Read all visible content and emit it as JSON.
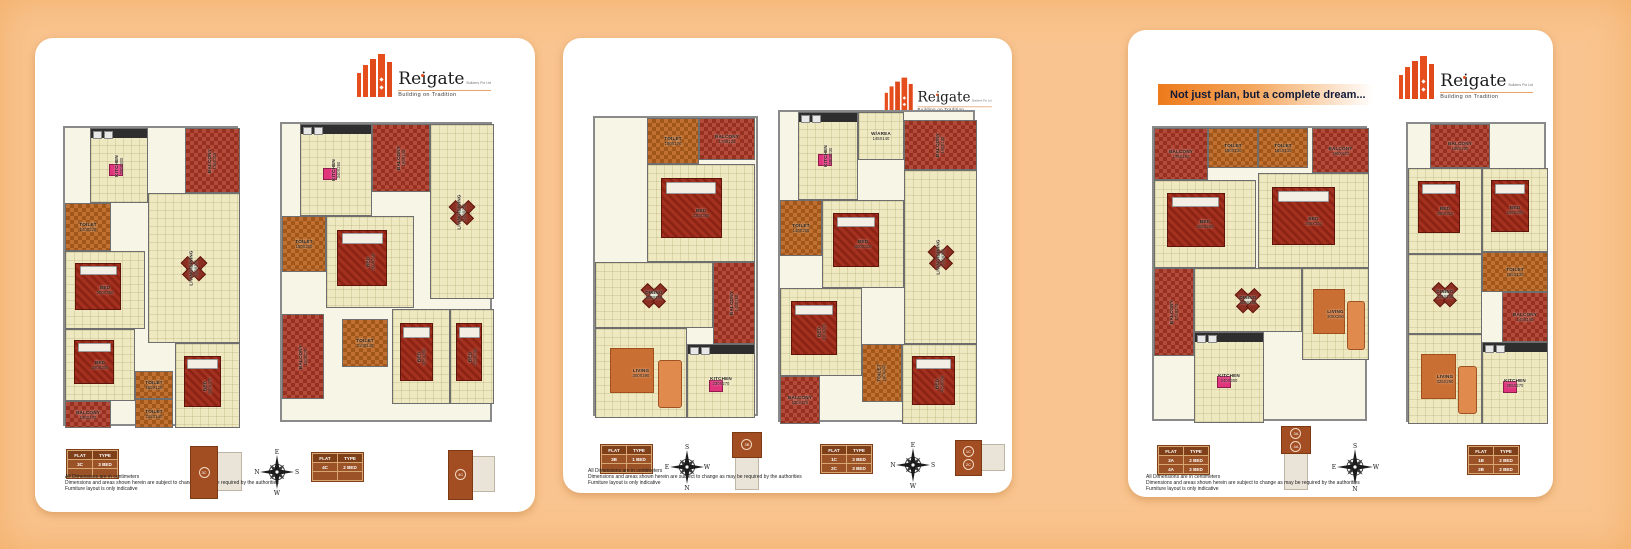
{
  "colors": {
    "page_bg": "#f9c48f",
    "card_bg": "#ffffff",
    "accent_orange": "#e64f1d",
    "table_brown": "#9a5226",
    "tile_orange": "#c07030",
    "tile_red": "#b44a39",
    "floor_cream": "#efe9c2",
    "banner_gradient_start": "#ed7a1b",
    "banner_text": "#101a38"
  },
  "logo": {
    "name": "Reigate",
    "suffix": "Builders Pvt Ltd",
    "tagline": "Building on Tradition",
    "icon": "orange-building-bars-icon"
  },
  "banner": "Not just plan, but a complete dream...",
  "disclaimer": [
    "All Dimensions are in centimeters",
    "Dimensions and areas shown herein are subject to change as may be required by the authorities",
    "Furniture layout is only indicative"
  ],
  "flat_table_header": [
    "FLAT",
    "TYPE"
  ],
  "panels": [
    {
      "plans": [
        {
          "box": {
            "x": 28,
            "y": 88,
            "w": 175,
            "h": 300
          },
          "rooms": [
            {
              "label": "KITCHEN",
              "dim": "230X300",
              "x": 25,
              "y": 0,
              "w": 58,
              "h": 75,
              "floor": "cream",
              "vert": true,
              "furn": "counter"
            },
            {
              "label": "BALCONY",
              "dim": "130X315",
              "x": 120,
              "y": 0,
              "w": 55,
              "h": 65,
              "floor": "red",
              "vert": true
            },
            {
              "label": "TOILET",
              "dim": "140X220",
              "x": 0,
              "y": 75,
              "w": 46,
              "h": 48,
              "floor": "orange"
            },
            {
              "label": "LIVING/DINING",
              "dim": "600X370",
              "x": 83,
              "y": 65,
              "w": 92,
              "h": 150,
              "floor": "cream",
              "vert": true,
              "furn": "dining"
            },
            {
              "label": "BED",
              "dim": "300X350",
              "x": 0,
              "y": 123,
              "w": 80,
              "h": 78,
              "floor": "cream",
              "furn": "bed"
            },
            {
              "label": "BED",
              "dim": "280X300",
              "x": 0,
              "y": 201,
              "w": 70,
              "h": 72,
              "floor": "cream",
              "furn": "bed"
            },
            {
              "label": "BED",
              "dim": "300X375",
              "x": 110,
              "y": 215,
              "w": 65,
              "h": 85,
              "floor": "cream",
              "vert": true,
              "furn": "bed"
            },
            {
              "label": "TOILET",
              "dim": "185X120",
              "x": 70,
              "y": 243,
              "w": 38,
              "h": 28,
              "floor": "orange"
            },
            {
              "label": "TOILET",
              "dim": "215X140",
              "x": 70,
              "y": 271,
              "w": 38,
              "h": 29,
              "floor": "orange"
            },
            {
              "label": "BALCONY",
              "dim": "130X170",
              "x": 0,
              "y": 273,
              "w": 46,
              "h": 27,
              "floor": "red"
            }
          ]
        },
        {
          "box": {
            "x": 245,
            "y": 84,
            "w": 212,
            "h": 300
          },
          "rooms": [
            {
              "label": "KITCHEN",
              "dim": "340X260",
              "x": 18,
              "y": 0,
              "w": 72,
              "h": 92,
              "floor": "cream",
              "vert": true,
              "furn": "counter"
            },
            {
              "label": "BALCONY",
              "dim": "190X140",
              "x": 90,
              "y": 0,
              "w": 58,
              "h": 68,
              "floor": "red",
              "vert": true
            },
            {
              "label": "LIVING/DINING",
              "dim": "500X250",
              "x": 148,
              "y": 0,
              "w": 64,
              "h": 175,
              "floor": "cream",
              "vert": true,
              "furn": "dining"
            },
            {
              "label": "TOILET",
              "dim": "150X210",
              "x": 0,
              "y": 92,
              "w": 44,
              "h": 56,
              "floor": "orange"
            },
            {
              "label": "BED",
              "dim": "360X310",
              "x": 44,
              "y": 92,
              "w": 88,
              "h": 92,
              "floor": "cream",
              "vert": true,
              "furn": "bed"
            },
            {
              "label": "BALCONY",
              "dim": "160X270",
              "x": 0,
              "y": 190,
              "w": 42,
              "h": 85,
              "floor": "red",
              "vert": true
            },
            {
              "label": "TOILET",
              "dim": "210X140",
              "x": 60,
              "y": 195,
              "w": 46,
              "h": 48,
              "floor": "orange"
            },
            {
              "label": "BED",
              "dim": "325X290",
              "x": 110,
              "y": 185,
              "w": 58,
              "h": 95,
              "floor": "cream",
              "vert": true,
              "furn": "bed"
            },
            {
              "label": "BED",
              "dim": "255X290",
              "x": 168,
              "y": 185,
              "w": 44,
              "h": 95,
              "floor": "cream",
              "vert": true,
              "furn": "bed"
            }
          ]
        }
      ],
      "legend": [
        {
          "type": "table",
          "x": 32,
          "y": 412,
          "rows": [
            [
              "3C",
              "3 BED"
            ],
            [
              "",
              ""
            ]
          ]
        },
        {
          "type": "keyplan",
          "x": 155,
          "y": 406,
          "w": 50,
          "h": 55,
          "layout": "h",
          "ids": [
            "3C"
          ]
        },
        {
          "type": "compass",
          "x": 218,
          "y": 410,
          "size": 48,
          "letters": {
            "t": "E",
            "r": "S",
            "b": "W",
            "l": "N"
          }
        },
        {
          "type": "table",
          "x": 277,
          "y": 415,
          "rows": [
            [
              "4C",
              "2 BED"
            ],
            [
              "",
              ""
            ]
          ]
        },
        {
          "type": "keyplan",
          "x": 413,
          "y": 410,
          "w": 45,
          "h": 52,
          "layout": "h",
          "ids": [
            "4C"
          ]
        }
      ]
    },
    {
      "plans": [
        {
          "box": {
            "x": 30,
            "y": 78,
            "w": 165,
            "h": 300
          },
          "rooms": [
            {
              "label": "TOILET",
              "dim": "180X170",
              "x": 52,
              "y": 0,
              "w": 52,
              "h": 46,
              "floor": "orange"
            },
            {
              "label": "BALCONY",
              "dim": "170X120",
              "x": 104,
              "y": 0,
              "w": 56,
              "h": 42,
              "floor": "red"
            },
            {
              "label": "BED",
              "dim": "330X360",
              "x": 52,
              "y": 46,
              "w": 108,
              "h": 98,
              "floor": "cream",
              "furn": "bed"
            },
            {
              "label": "DINING",
              "dim": "400X260",
              "x": 0,
              "y": 144,
              "w": 118,
              "h": 66,
              "floor": "cream",
              "furn": "dining"
            },
            {
              "label": "BALCONY",
              "dim": "140X260",
              "x": 118,
              "y": 144,
              "w": 42,
              "h": 82,
              "floor": "red",
              "vert": true
            },
            {
              "label": "LIVING",
              "dim": "300X290",
              "x": 0,
              "y": 210,
              "w": 92,
              "h": 90,
              "floor": "cream",
              "furn": "sofa"
            },
            {
              "label": "KITCHEN",
              "dim": "230X270",
              "x": 92,
              "y": 226,
              "w": 68,
              "h": 74,
              "floor": "cream",
              "furn": "counter"
            }
          ]
        },
        {
          "box": {
            "x": 215,
            "y": 72,
            "w": 197,
            "h": 312
          },
          "rooms": [
            {
              "label": "KITCHEN",
              "dim": "280X230",
              "x": 18,
              "y": 0,
              "w": 60,
              "h": 88,
              "floor": "cream",
              "vert": true,
              "furn": "counter"
            },
            {
              "label": "W/AREA",
              "dim": "145X140",
              "x": 78,
              "y": 0,
              "w": 46,
              "h": 48,
              "floor": "cream"
            },
            {
              "label": "BALCONY",
              "dim": "190X130",
              "x": 124,
              "y": 8,
              "w": 73,
              "h": 50,
              "floor": "red",
              "vert": true
            },
            {
              "label": "TOILET",
              "dim": "140X210",
              "x": 0,
              "y": 88,
              "w": 42,
              "h": 56,
              "floor": "orange"
            },
            {
              "label": "LIVING/DINING",
              "dim": "600X300",
              "x": 124,
              "y": 58,
              "w": 73,
              "h": 174,
              "floor": "cream",
              "vert": true,
              "furn": "dining"
            },
            {
              "label": "BED",
              "dim": "300X310",
              "x": 42,
              "y": 88,
              "w": 82,
              "h": 88,
              "floor": "cream",
              "furn": "bed"
            },
            {
              "label": "BED",
              "dim": "310X320",
              "x": 0,
              "y": 176,
              "w": 82,
              "h": 88,
              "floor": "cream",
              "vert": true,
              "furn": "bed"
            },
            {
              "label": "TOILET",
              "dim": "140X240",
              "x": 82,
              "y": 232,
              "w": 40,
              "h": 58,
              "floor": "orange",
              "vert": true
            },
            {
              "label": "BALCONY",
              "dim": "130X175",
              "x": 0,
              "y": 264,
              "w": 40,
              "h": 48,
              "floor": "red"
            },
            {
              "label": "BED",
              "dim": "425X300",
              "x": 122,
              "y": 232,
              "w": 75,
              "h": 80,
              "floor": "cream",
              "vert": true,
              "furn": "bed"
            }
          ]
        }
      ],
      "legend": [
        {
          "type": "table",
          "x": 38,
          "y": 407,
          "rows": [
            [
              "3B",
              "1 BED"
            ],
            [
              "",
              ""
            ]
          ]
        },
        {
          "type": "compass",
          "x": 100,
          "y": 405,
          "size": 48,
          "letters": {
            "t": "S",
            "r": "W",
            "b": "N",
            "l": "E"
          }
        },
        {
          "type": "keyplan",
          "x": 166,
          "y": 394,
          "w": 34,
          "h": 56,
          "layout": "v",
          "ids": [
            "3B"
          ]
        },
        {
          "type": "table",
          "x": 258,
          "y": 407,
          "rows": [
            [
              "1C",
              "3 BED"
            ],
            [
              "2C",
              "3 BED"
            ]
          ]
        },
        {
          "type": "compass",
          "x": 326,
          "y": 403,
          "size": 48,
          "letters": {
            "t": "E",
            "r": "S",
            "b": "W",
            "l": "N"
          }
        },
        {
          "type": "keyplan",
          "x": 392,
          "y": 400,
          "w": 48,
          "h": 38,
          "layout": "h",
          "ids": [
            "1C",
            "2C"
          ]
        }
      ]
    },
    {
      "plans": [
        {
          "box": {
            "x": 24,
            "y": 96,
            "w": 215,
            "h": 295
          },
          "rooms": [
            {
              "label": "BALCONY",
              "dim": "175X150",
              "x": 0,
              "y": 0,
              "w": 54,
              "h": 52,
              "floor": "red"
            },
            {
              "label": "TOILET",
              "dim": "180X130",
              "x": 54,
              "y": 0,
              "w": 50,
              "h": 40,
              "floor": "orange"
            },
            {
              "label": "TOILET",
              "dim": "185X130",
              "x": 104,
              "y": 0,
              "w": 50,
              "h": 40,
              "floor": "orange"
            },
            {
              "label": "BALCONY",
              "dim": "195X120",
              "x": 158,
              "y": 0,
              "w": 57,
              "h": 45,
              "floor": "red"
            },
            {
              "label": "BED",
              "dim": "355X290",
              "x": 0,
              "y": 52,
              "w": 102,
              "h": 88,
              "floor": "cream",
              "furn": "bed"
            },
            {
              "label": "BED",
              "dim": "390X310",
              "x": 104,
              "y": 45,
              "w": 111,
              "h": 95,
              "floor": "cream",
              "furn": "bed"
            },
            {
              "label": "BALCONY",
              "dim": "175X270",
              "x": 0,
              "y": 140,
              "w": 40,
              "h": 88,
              "floor": "red",
              "vert": true
            },
            {
              "label": "DINING",
              "dim": "400X280",
              "x": 40,
              "y": 140,
              "w": 108,
              "h": 64,
              "floor": "cream",
              "furn": "dining"
            },
            {
              "label": "LIVING",
              "dim": "300X250",
              "x": 148,
              "y": 140,
              "w": 67,
              "h": 92,
              "floor": "cream",
              "furn": "sofa"
            },
            {
              "label": "KITCHEN",
              "dim": "240X300",
              "x": 40,
              "y": 204,
              "w": 70,
              "h": 91,
              "floor": "cream",
              "furn": "counter"
            }
          ]
        },
        {
          "box": {
            "x": 278,
            "y": 92,
            "w": 140,
            "h": 300
          },
          "rooms": [
            {
              "label": "BALCONY",
              "dim": "195X120",
              "x": 22,
              "y": 0,
              "w": 60,
              "h": 44,
              "floor": "red"
            },
            {
              "label": "BED",
              "dim": "290X310",
              "x": 0,
              "y": 44,
              "w": 74,
              "h": 86,
              "floor": "cream",
              "furn": "bed"
            },
            {
              "label": "BED",
              "dim": "295X300",
              "x": 74,
              "y": 44,
              "w": 66,
              "h": 84,
              "floor": "cream",
              "furn": "bed"
            },
            {
              "label": "TOILET",
              "dim": "165X130",
              "x": 74,
              "y": 128,
              "w": 66,
              "h": 40,
              "floor": "orange"
            },
            {
              "label": "DINING",
              "dim": "425X250",
              "x": 0,
              "y": 130,
              "w": 74,
              "h": 80,
              "floor": "cream",
              "furn": "dining"
            },
            {
              "label": "BALCONY",
              "dim": "145X160",
              "x": 94,
              "y": 168,
              "w": 46,
              "h": 50,
              "floor": "red"
            },
            {
              "label": "LIVING",
              "dim": "325X290",
              "x": 0,
              "y": 210,
              "w": 74,
              "h": 90,
              "floor": "cream",
              "furn": "sofa"
            },
            {
              "label": "KITCHEN",
              "dim": "255X270",
              "x": 74,
              "y": 218,
              "w": 66,
              "h": 82,
              "floor": "cream",
              "furn": "counter"
            }
          ]
        }
      ],
      "legend": [
        {
          "type": "table",
          "x": 30,
          "y": 416,
          "rows": [
            [
              "3A",
              "2 BED"
            ],
            [
              "4A",
              "2 BED"
            ]
          ]
        },
        {
          "type": "keyplan",
          "x": 150,
          "y": 396,
          "w": 34,
          "h": 62,
          "layout": "v",
          "ids": [
            "3A",
            "4A"
          ]
        },
        {
          "type": "compass",
          "x": 202,
          "y": 412,
          "size": 50,
          "letters": {
            "t": "S",
            "r": "W",
            "b": "N",
            "l": "E"
          }
        },
        {
          "type": "table",
          "x": 340,
          "y": 416,
          "rows": [
            [
              "1B",
              "2 BED"
            ],
            [
              "2B",
              "2 BED"
            ]
          ]
        }
      ]
    }
  ]
}
